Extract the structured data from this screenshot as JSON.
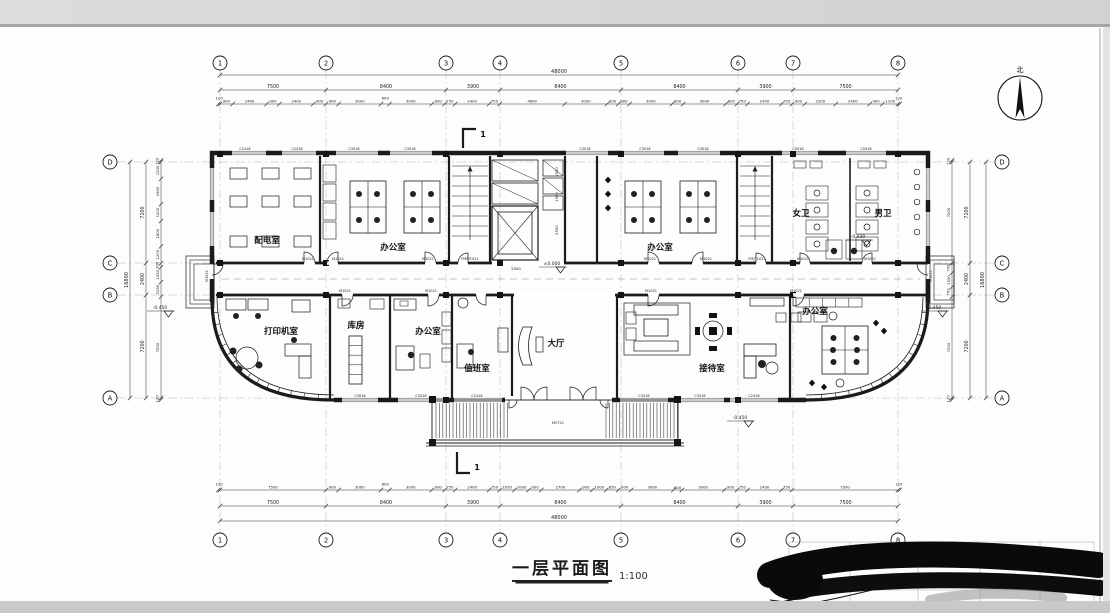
{
  "page": {
    "title": "一层平面图",
    "scale": "1:100",
    "north_label": "北"
  },
  "grid": {
    "x": [
      {
        "label": "1",
        "x": 220
      },
      {
        "label": "2",
        "x": 326
      },
      {
        "label": "3",
        "x": 446
      },
      {
        "label": "4",
        "x": 500
      },
      {
        "label": "5",
        "x": 621
      },
      {
        "label": "6",
        "x": 738
      },
      {
        "label": "7",
        "x": 793
      },
      {
        "label": "8",
        "x": 898
      }
    ],
    "y": [
      {
        "label": "D",
        "y": 162
      },
      {
        "label": "C",
        "y": 263
      },
      {
        "label": "B",
        "y": 295
      },
      {
        "label": "A",
        "y": 398
      }
    ]
  },
  "dims": {
    "top": {
      "total": "48000",
      "spans": [
        "7500",
        "8400",
        "3900",
        "8400",
        "8400",
        "3900",
        "7500"
      ],
      "detail": [
        "120",
        "900",
        "2400",
        "900",
        "2400",
        "900",
        "900",
        "3000",
        "600",
        "3000",
        "900",
        "750",
        "2400",
        "750",
        "4600",
        "3000",
        "800",
        "800",
        "3000",
        "800",
        "3000",
        "800",
        "750",
        "2400",
        "750",
        "900",
        "2200",
        "2400",
        "900",
        "1100",
        "120"
      ]
    },
    "bottom": {
      "total": "48000",
      "spans": [
        "7500",
        "8400",
        "3900",
        "8400",
        "8400",
        "3900",
        "7500"
      ],
      "detail": [
        "120",
        "7500",
        "900",
        "3000",
        "600",
        "3000",
        "900",
        "750",
        "2400",
        "750",
        "1050",
        "1000",
        "900",
        "2700",
        "900",
        "1000",
        "850",
        "900",
        "3000",
        "600",
        "3000",
        "900",
        "750",
        "2400",
        "750",
        "7500",
        "120"
      ]
    },
    "left": {
      "total": "16800",
      "spans": [
        "7200",
        "2400",
        "7200"
      ],
      "detail": [
        "120",
        "1200",
        "1800",
        "1200",
        "1800",
        "1200",
        "300",
        "1050",
        "1050",
        "7200",
        "120"
      ]
    },
    "right": {
      "total": "16800",
      "spans": [
        "7200",
        "2400",
        "7200"
      ],
      "detail": [
        "120",
        "7200",
        "700",
        "1000",
        "700",
        "7200",
        "120"
      ]
    }
  },
  "rooms": [
    {
      "name": "配电室",
      "x": 267,
      "y": 243
    },
    {
      "name": "办公室",
      "x": 393,
      "y": 250
    },
    {
      "name": "办公室",
      "x": 660,
      "y": 250
    },
    {
      "name": "女卫",
      "x": 801,
      "y": 216
    },
    {
      "name": "男卫",
      "x": 883,
      "y": 216
    },
    {
      "name": "打印机室",
      "x": 281,
      "y": 334
    },
    {
      "name": "库房",
      "x": 356,
      "y": 328
    },
    {
      "name": "办公室",
      "x": 428,
      "y": 334
    },
    {
      "name": "值班室",
      "x": 477,
      "y": 371
    },
    {
      "name": "大厅",
      "x": 556,
      "y": 346
    },
    {
      "name": "接待室",
      "x": 712,
      "y": 371
    },
    {
      "name": "办公室",
      "x": 815,
      "y": 314
    }
  ],
  "markers": [
    {
      "t": "±0.000",
      "x": 552,
      "y": 265
    },
    {
      "t": "-0.450",
      "x": 160,
      "y": 309
    },
    {
      "t": "-0.450",
      "x": 934,
      "y": 309
    },
    {
      "t": "-0.450",
      "x": 740,
      "y": 419
    },
    {
      "t": "-0.030",
      "x": 858,
      "y": 238
    }
  ],
  "window_labels": [
    {
      "t": "C2418",
      "x": 245,
      "y": 150
    },
    {
      "t": "C2418",
      "x": 297,
      "y": 150
    },
    {
      "t": "C3018",
      "x": 354,
      "y": 150
    },
    {
      "t": "C3018",
      "x": 410,
      "y": 150
    },
    {
      "t": "C3018",
      "x": 585,
      "y": 150
    },
    {
      "t": "C3018",
      "x": 645,
      "y": 150
    },
    {
      "t": "C3018",
      "x": 703,
      "y": 150
    },
    {
      "t": "C0918",
      "x": 798,
      "y": 150
    },
    {
      "t": "C0918",
      "x": 866,
      "y": 150
    },
    {
      "t": "C3018",
      "x": 360,
      "y": 397
    },
    {
      "t": "C3018",
      "x": 421,
      "y": 397
    },
    {
      "t": "C2418",
      "x": 477,
      "y": 397
    },
    {
      "t": "C3018",
      "x": 644,
      "y": 397
    },
    {
      "t": "C3018",
      "x": 700,
      "y": 397
    },
    {
      "t": "C2418",
      "x": 754,
      "y": 397
    }
  ],
  "door_labels": [
    {
      "t": "M1021",
      "x": 308,
      "y": 260
    },
    {
      "t": "M1021",
      "x": 338,
      "y": 260
    },
    {
      "t": "M1021",
      "x": 428,
      "y": 260
    },
    {
      "t": "FM甲1021",
      "x": 470,
      "y": 260
    },
    {
      "t": "M1021",
      "x": 650,
      "y": 260
    },
    {
      "t": "M1021",
      "x": 706,
      "y": 260
    },
    {
      "t": "FM乙1021",
      "x": 757,
      "y": 260
    },
    {
      "t": "M1021",
      "x": 803,
      "y": 260
    },
    {
      "t": "M1021",
      "x": 870,
      "y": 260
    },
    {
      "t": "M1021",
      "x": 345,
      "y": 292
    },
    {
      "t": "M1021",
      "x": 431,
      "y": 292
    },
    {
      "t": "M1021",
      "x": 651,
      "y": 292
    },
    {
      "t": "M1021",
      "x": 796,
      "y": 292
    },
    {
      "t": "M2721",
      "x": 558,
      "y": 424
    },
    {
      "t": "M1021",
      "x": 208,
      "y": 276,
      "r": -90
    },
    {
      "t": "M1021",
      "x": 932,
      "y": 276,
      "r": -90
    }
  ],
  "extra_dims": [
    {
      "t": "2500",
      "x": 516,
      "y": 270
    },
    {
      "t": "1500",
      "x": 558,
      "y": 172,
      "r": -90
    },
    {
      "t": "1500",
      "x": 558,
      "y": 197,
      "r": -90
    },
    {
      "t": "2500",
      "x": 558,
      "y": 230,
      "r": -90
    }
  ],
  "section_marks": [
    {
      "label": "1",
      "x": 483,
      "y": 137
    },
    {
      "label": "1",
      "x": 477,
      "y": 470
    }
  ]
}
